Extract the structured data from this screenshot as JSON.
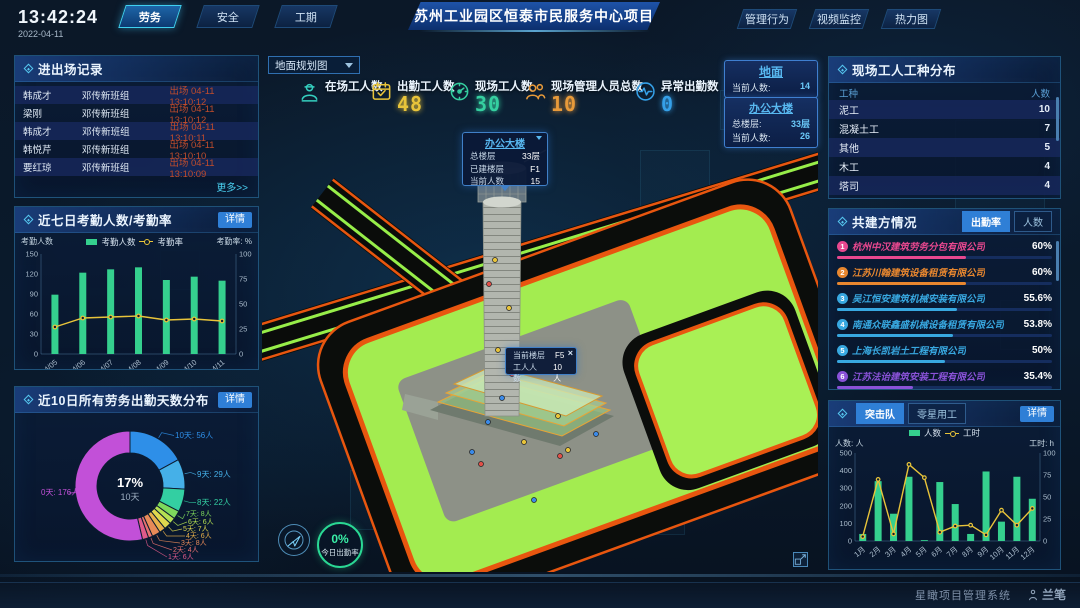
{
  "colors": {
    "accent": "#35c0e8",
    "bar_green": "#35d08e",
    "line_yellow": "#e8c43a",
    "alert_red": "#bf4c2c",
    "btn_blue": "#2f7fd6"
  },
  "header": {
    "time": "13:42:24",
    "date": "2022-04-11",
    "nav_left": [
      {
        "label": "劳务",
        "active": true
      },
      {
        "label": "安全",
        "active": false
      },
      {
        "label": "工期",
        "active": false
      }
    ],
    "title": "苏州工业园区恒泰市民服务中心项目",
    "nav_right": [
      {
        "label": "管理行为",
        "active": false
      },
      {
        "label": "视频监控",
        "active": false
      },
      {
        "label": "热力图",
        "active": false
      }
    ]
  },
  "entry_exit": {
    "title": "进出场记录",
    "more": "更多>>",
    "rows": [
      {
        "name": "韩成才",
        "team": "邓传新班组",
        "event": "出场 04-11 13:10:12"
      },
      {
        "name": "梁刚",
        "team": "邓传新班组",
        "event": "出场 04-11 13:10:12"
      },
      {
        "name": "韩成才",
        "team": "邓传新班组",
        "event": "出场 04-11 13:10:11"
      },
      {
        "name": "韩悦芹",
        "team": "邓传新班组",
        "event": "出场 04-11 13:10:10"
      },
      {
        "name": "要红琼",
        "team": "邓传新班组",
        "event": "出场 04-11 13:10:09"
      }
    ]
  },
  "weekly_attendance": {
    "title": "近七日考勤人数/考勤率",
    "detail": "详情",
    "chart_data": {
      "type": "bar+line",
      "categories": [
        "04/05",
        "04/06",
        "04/07",
        "04/08",
        "04/09",
        "04/10",
        "04/11"
      ],
      "series": [
        {
          "name": "考勤人数",
          "type": "bar",
          "color": "#35d08e",
          "axis": "left",
          "values": [
            89,
            122,
            127,
            130,
            111,
            116,
            110
          ]
        },
        {
          "name": "考勤率",
          "type": "line",
          "color": "#e8c43a",
          "axis": "right",
          "values": [
            27,
            36,
            37,
            38,
            34,
            35,
            33
          ]
        }
      ],
      "left_axis": {
        "label": "考勤人数",
        "min": 0,
        "max": 150,
        "step": 30
      },
      "right_axis": {
        "label": "考勤率: %",
        "min": 0,
        "max": 100,
        "step": 25
      }
    }
  },
  "distribution": {
    "title": "近10日所有劳务出勤天数分布",
    "detail": "详情",
    "center_value": "17%",
    "center_label": "10天",
    "chart_data": {
      "type": "pie",
      "slices": [
        {
          "label": "10天: 56人",
          "value": 56,
          "color": "#2e8fe8"
        },
        {
          "label": "9天: 29人",
          "value": 29,
          "color": "#45b0e8"
        },
        {
          "label": "8天: 22人",
          "value": 22,
          "color": "#33cfa2"
        },
        {
          "label": "7天: 8人",
          "value": 8,
          "color": "#7ed85c"
        },
        {
          "label": "6天: 6人",
          "value": 6,
          "color": "#b4e052"
        },
        {
          "label": "5天: 7人",
          "value": 7,
          "color": "#e0d84e"
        },
        {
          "label": "4天: 6人",
          "value": 6,
          "color": "#e8b04a"
        },
        {
          "label": "3天: 8人",
          "value": 8,
          "color": "#e88a58"
        },
        {
          "label": "2天: 4人",
          "value": 4,
          "color": "#e87070"
        },
        {
          "label": "1天: 6人",
          "value": 6,
          "color": "#e05a8a"
        },
        {
          "label": "0天: 176人",
          "value": 176,
          "color": "#c250d8"
        }
      ]
    }
  },
  "scene": {
    "view_select": "地面规划图",
    "stats": [
      {
        "label": "在场工人数",
        "value": "",
        "color": "#35d0c0",
        "icon": "worker"
      },
      {
        "label": "出勤工人数",
        "value": "48",
        "color": "#e8c43a",
        "icon": "calendar"
      },
      {
        "label": "现场工人数",
        "value": "30",
        "color": "#35cfa0",
        "icon": "meter"
      },
      {
        "label": "现场管理人员总数",
        "value": "10",
        "color": "#e89a3a",
        "icon": "people"
      },
      {
        "label": "异常出勤数",
        "value": "0",
        "color": "#35a0e8",
        "icon": "pulse"
      }
    ],
    "ground_card": {
      "title": "地面",
      "rows": [
        {
          "label": "当前人数:",
          "value": "14"
        }
      ]
    },
    "tower_card": {
      "title": "办公大楼",
      "rows": [
        {
          "label": "总楼层:",
          "value": "33层"
        },
        {
          "label": "当前人数:",
          "value": "26"
        }
      ]
    },
    "tower_tooltip": {
      "title": "办公大楼",
      "rows": [
        {
          "label": "总楼层",
          "value": "33层"
        },
        {
          "label": "已建楼层",
          "value": "F1"
        },
        {
          "label": "当前人数",
          "value": "15"
        }
      ]
    },
    "floor_tooltip": {
      "close": "×",
      "rows": [
        {
          "label": "当前楼层",
          "value": "F5"
        },
        {
          "label": "工人人数",
          "value": "10人"
        }
      ]
    },
    "gauge": {
      "value": "0%",
      "label": "今日出勤率"
    }
  },
  "worker_types": {
    "title": "现场工人工种分布",
    "columns": [
      "工种",
      "人数"
    ],
    "rows": [
      [
        "泥工",
        "10"
      ],
      [
        "混凝土工",
        "7"
      ],
      [
        "其他",
        "5"
      ],
      [
        "木工",
        "4"
      ],
      [
        "塔司",
        "4"
      ]
    ]
  },
  "partners": {
    "title": "共建方情况",
    "tabs": [
      {
        "label": "出勤率",
        "active": true
      },
      {
        "label": "人数",
        "active": false
      }
    ],
    "items": [
      {
        "rank": "1",
        "name": "杭州中汉建筑劳务分包有限公司",
        "value": "60%",
        "pct": 60,
        "color": "#e8488f"
      },
      {
        "rank": "2",
        "name": "江苏川翰建筑设备租赁有限公司",
        "value": "60%",
        "pct": 60,
        "color": "#e8872f"
      },
      {
        "rank": "3",
        "name": "吴江恒安建筑机械安装有限公司",
        "value": "55.6%",
        "pct": 55.6,
        "color": "#38a8e0"
      },
      {
        "rank": "4",
        "name": "南通众联鑫盛机械设备租赁有限公司",
        "value": "53.8%",
        "pct": 53.8,
        "color": "#38a8e0"
      },
      {
        "rank": "5",
        "name": "上海长凯岩土工程有限公司",
        "value": "50%",
        "pct": 50,
        "color": "#38a8e0"
      },
      {
        "rank": "6",
        "name": "江苏法诒建筑安装工程有限公司",
        "value": "35.4%",
        "pct": 35.4,
        "color": "#8a52d8"
      }
    ]
  },
  "squad": {
    "tabs": [
      {
        "label": "突击队",
        "active": true
      },
      {
        "label": "零星用工",
        "active": false
      }
    ],
    "detail": "详情",
    "chart_data": {
      "type": "bar+line",
      "categories": [
        "1月",
        "2月",
        "3月",
        "4月",
        "5月",
        "6月",
        "7月",
        "8月",
        "9月",
        "10月",
        "11月",
        "12月"
      ],
      "series": [
        {
          "name": "人数",
          "type": "bar",
          "color": "#35d08e",
          "axis": "left",
          "values": [
            40,
            340,
            155,
            365,
            5,
            335,
            210,
            40,
            395,
            110,
            365,
            240
          ]
        },
        {
          "name": "工时",
          "type": "line",
          "color": "#e8c43a",
          "axis": "right",
          "values": [
            5,
            70,
            8,
            87,
            72,
            10,
            17,
            18,
            7,
            35,
            18,
            37
          ]
        }
      ],
      "left_axis": {
        "label": "人数: 人",
        "min": 0,
        "max": 500,
        "step": 100
      },
      "right_axis": {
        "label": "工时: h",
        "min": 0,
        "max": 100,
        "step": 25
      }
    }
  },
  "footer": {
    "system_name": "星瞰项目管理系统",
    "brand": "兰笔"
  }
}
